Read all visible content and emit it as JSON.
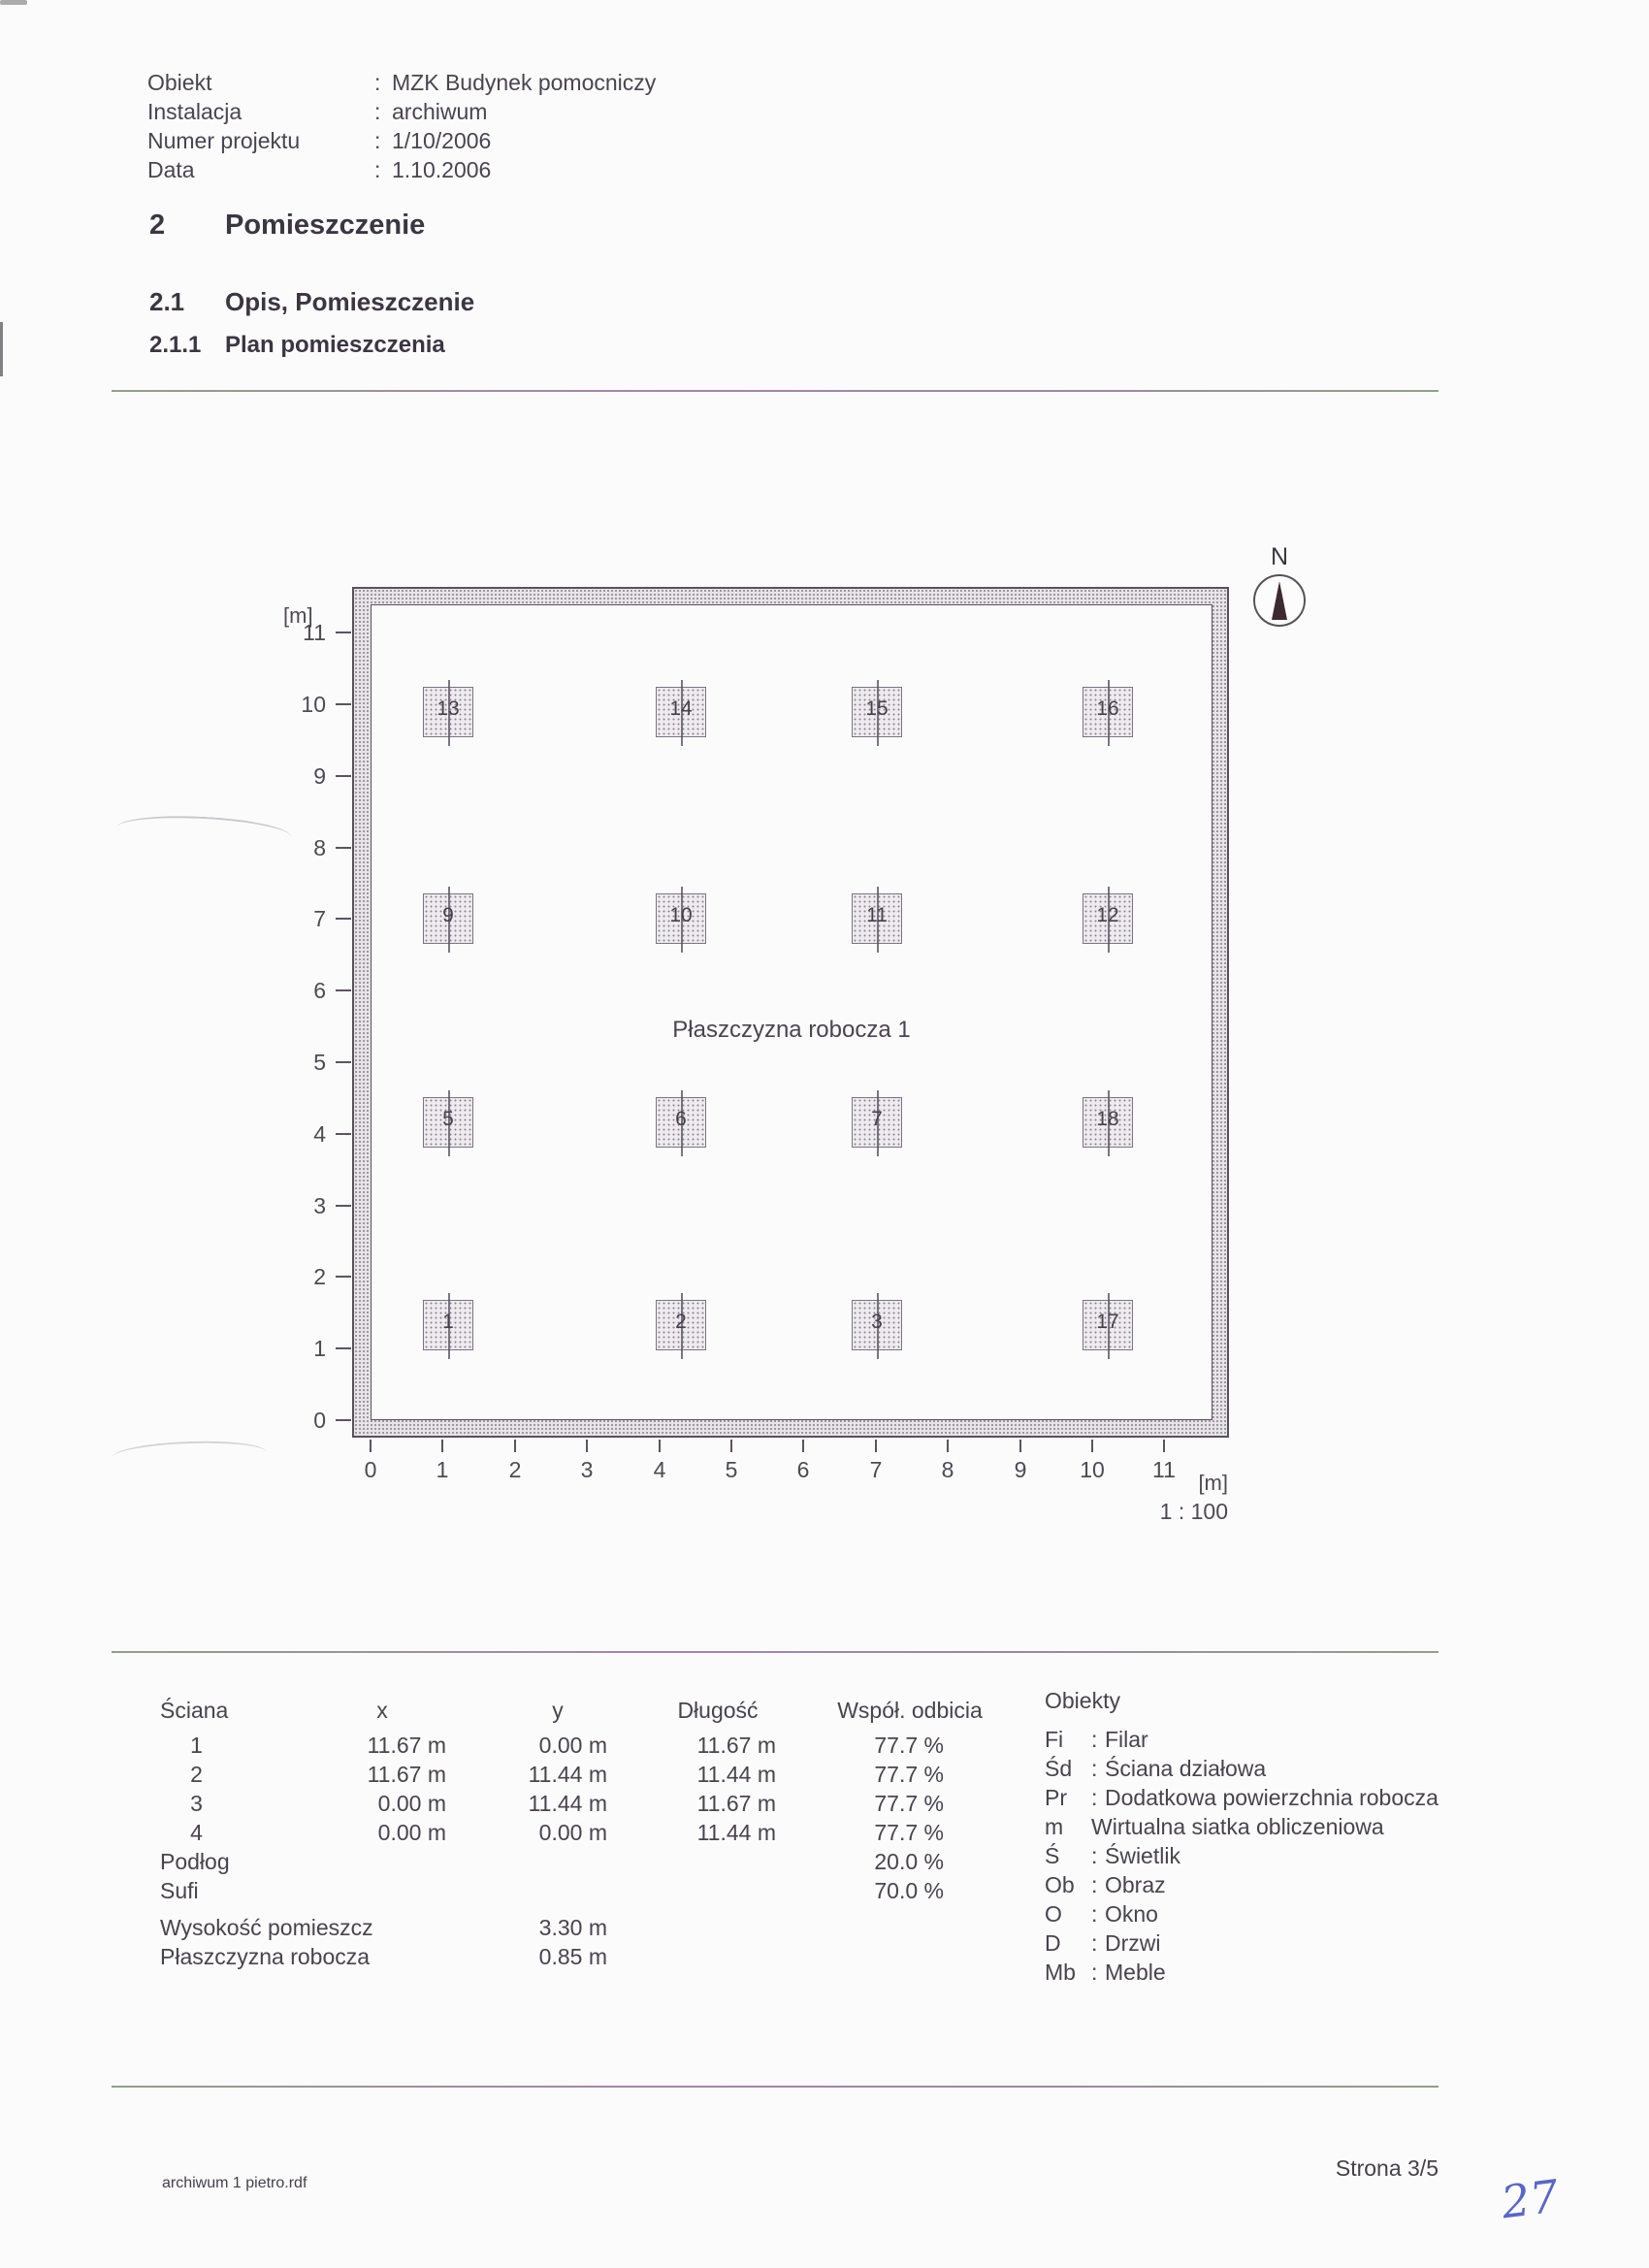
{
  "header": {
    "rows": [
      {
        "label": "Obiekt",
        "sep": ":",
        "value": "MZK Budynek pomocniczy"
      },
      {
        "label": "Instalacja",
        "sep": ":",
        "value": "archiwum"
      },
      {
        "label": "Numer projektu",
        "sep": ":",
        "value": "1/10/2006"
      },
      {
        "label": "Data",
        "sep": ":",
        "value": "1.10.2006"
      }
    ]
  },
  "sections": {
    "s2": {
      "num": "2",
      "title": "Pomieszczenie"
    },
    "s21": {
      "num": "2.1",
      "title": "Opis, Pomieszczenie"
    },
    "s211": {
      "num": "2.1.1",
      "title": "Plan pomieszczenia"
    }
  },
  "plan": {
    "unit_label": "[m]",
    "x_unit_label": "[m]",
    "scale_label": "1 : 100",
    "north_label": "N",
    "work_plane_label": "Płaszczyzna robocza 1",
    "y_ticks": [
      "0",
      "1",
      "2",
      "3",
      "4",
      "5",
      "6",
      "7",
      "8",
      "9",
      "10",
      "11"
    ],
    "x_ticks": [
      "0",
      "1",
      "2",
      "3",
      "4",
      "5",
      "6",
      "7",
      "8",
      "9",
      "10",
      "11"
    ],
    "room_width_m": 11.67,
    "room_depth_m": 11.44,
    "luminaires": [
      {
        "id": "1",
        "x_m": 1.08,
        "y_m": 1.33
      },
      {
        "id": "2",
        "x_m": 4.3,
        "y_m": 1.33
      },
      {
        "id": "3",
        "x_m": 7.02,
        "y_m": 1.33
      },
      {
        "id": "17",
        "x_m": 10.22,
        "y_m": 1.33
      },
      {
        "id": "5",
        "x_m": 1.08,
        "y_m": 4.16
      },
      {
        "id": "6",
        "x_m": 4.3,
        "y_m": 4.16
      },
      {
        "id": "7",
        "x_m": 7.02,
        "y_m": 4.16
      },
      {
        "id": "18",
        "x_m": 10.22,
        "y_m": 4.16
      },
      {
        "id": "9",
        "x_m": 1.08,
        "y_m": 7.01
      },
      {
        "id": "10",
        "x_m": 4.3,
        "y_m": 7.01
      },
      {
        "id": "11",
        "x_m": 7.02,
        "y_m": 7.01
      },
      {
        "id": "12",
        "x_m": 10.22,
        "y_m": 7.01
      },
      {
        "id": "13",
        "x_m": 1.08,
        "y_m": 9.89
      },
      {
        "id": "14",
        "x_m": 4.3,
        "y_m": 9.89
      },
      {
        "id": "15",
        "x_m": 7.02,
        "y_m": 9.89
      },
      {
        "id": "16",
        "x_m": 10.22,
        "y_m": 9.89
      }
    ]
  },
  "table": {
    "headers": {
      "sciana": "Ściana",
      "x": "x",
      "y": "y",
      "dlugosc": "Długość",
      "wspol": "Współ. odbicia",
      "obiekty": "Obiekty"
    },
    "walls": [
      {
        "nr": "1",
        "x": "11.67 m",
        "y": "0.00 m",
        "len": "11.67 m",
        "refl": "77.7 %"
      },
      {
        "nr": "2",
        "x": "11.67 m",
        "y": "11.44 m",
        "len": "11.44 m",
        "refl": "77.7 %"
      },
      {
        "nr": "3",
        "x": "0.00 m",
        "y": "11.44 m",
        "len": "11.67 m",
        "refl": "77.7 %"
      },
      {
        "nr": "4",
        "x": "0.00 m",
        "y": "0.00 m",
        "len": "11.44 m",
        "refl": "77.7 %"
      }
    ],
    "floor": {
      "label": "Podłog",
      "refl": "20.0 %"
    },
    "ceiling": {
      "label": "Sufi",
      "refl": "70.0 %"
    },
    "props": [
      {
        "label": "Wysokość pomieszcz",
        "value": "3.30 m"
      },
      {
        "label": "Płaszczyzna robocza",
        "value": "0.85 m"
      }
    ]
  },
  "legend": {
    "title": "Obiekty",
    "items": [
      {
        "abbr": "Fi",
        "sep": ":",
        "desc": "Filar"
      },
      {
        "abbr": "Śd",
        "sep": ":",
        "desc": "Ściana działowa"
      },
      {
        "abbr": "Pr",
        "sep": ":",
        "desc": "Dodatkowa powierzchnia robocza"
      },
      {
        "abbr": "m",
        "sep": "",
        "desc": "Wirtualna siatka obliczeniowa"
      },
      {
        "abbr": "Ś",
        "sep": ":",
        "desc": "Świetlik"
      },
      {
        "abbr": "Ob",
        "sep": ":",
        "desc": "Obraz"
      },
      {
        "abbr": "O",
        "sep": ":",
        "desc": "Okno"
      },
      {
        "abbr": "D",
        "sep": ":",
        "desc": "Drzwi"
      },
      {
        "abbr": "Mb",
        "sep": ":",
        "desc": "Meble"
      }
    ]
  },
  "footer": {
    "filename": "archiwum 1 pietro.rdf",
    "page": "Strona 3/5",
    "handwritten": "27"
  },
  "colors": {
    "ink": "#4a4450",
    "heading": "#3c3642",
    "handwriting_blue": "#5b68c0",
    "wall_line": "#5a505c"
  }
}
